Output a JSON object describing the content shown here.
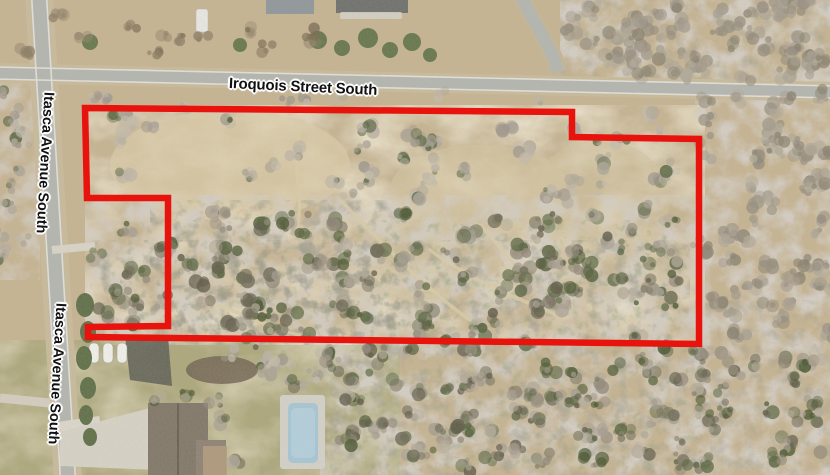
{
  "streets": {
    "iroquois": {
      "label": "Iroquois Street South"
    },
    "itasca_north": {
      "label": "Itasca Avenue South"
    },
    "itasca_south": {
      "label": "Itasca Avenue South"
    }
  },
  "parcel_boundary": {
    "points": "85,108 572,112 572,137 699,139 699,344 88,337 88,327 168,326 168,198 87,198",
    "color": "#e8130c",
    "stroke_width": 6.5
  },
  "palette": {
    "ground_tan": "#c6b492",
    "road_gray": "#b3b6b0",
    "woods_gray": "#9c948a",
    "lawn_green": "#a9a678",
    "pool_blue": "#a6c7d6",
    "label_text": "#111111",
    "label_halo": "#ffffff"
  }
}
